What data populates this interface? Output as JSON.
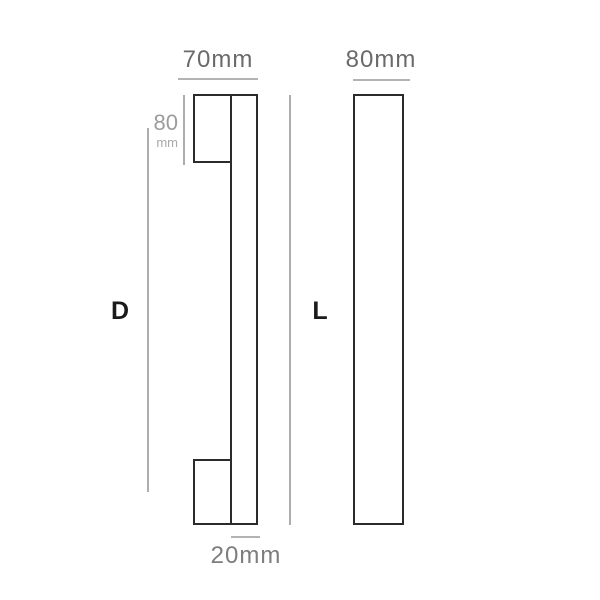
{
  "drawing": {
    "title": "pull-handle dimension drawing",
    "background": "#ffffff",
    "colors": {
      "outline": "#2b2b2b",
      "dimension_line": "#b3b3b3",
      "dimension_text": "#6a6a6a",
      "dimension_text_muted": "#9c9c9c",
      "letter_label_text": "#1b1b1b"
    },
    "side_view": {
      "top_width_label": "70mm",
      "foot_height_value": "80",
      "foot_height_unit": "mm",
      "length_label": "D",
      "bar_thickness_label": "20mm"
    },
    "front_view": {
      "top_width_label": "80mm",
      "length_label": "L"
    }
  }
}
